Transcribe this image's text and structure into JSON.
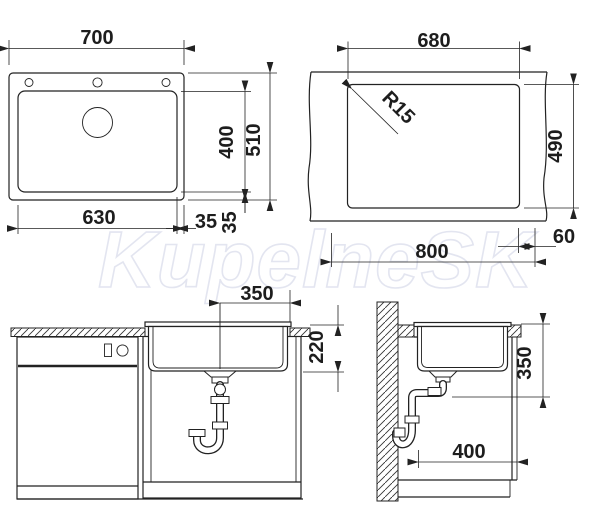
{
  "watermark": {
    "text": "KupelneSK"
  },
  "colors": {
    "line": "#222222",
    "watermark_outline": "#e3e5f0",
    "background": "#ffffff"
  },
  "views": {
    "top": {
      "labels": {
        "overall_width": "700",
        "bowl_depth": "400",
        "overall_depth": "510",
        "bowl_width": "630",
        "offset_right": "35",
        "offset_bottom": "35"
      }
    },
    "cutout": {
      "labels": {
        "cutout_width": "680",
        "corner_radius": "R15",
        "cutout_depth": "490",
        "span": "800",
        "edge_margin": "60"
      }
    },
    "front": {
      "labels": {
        "drain_offset": "350",
        "bowl_inner_depth": "220"
      }
    },
    "side": {
      "labels": {
        "install_height": "350",
        "clearance_depth": "400"
      }
    }
  }
}
